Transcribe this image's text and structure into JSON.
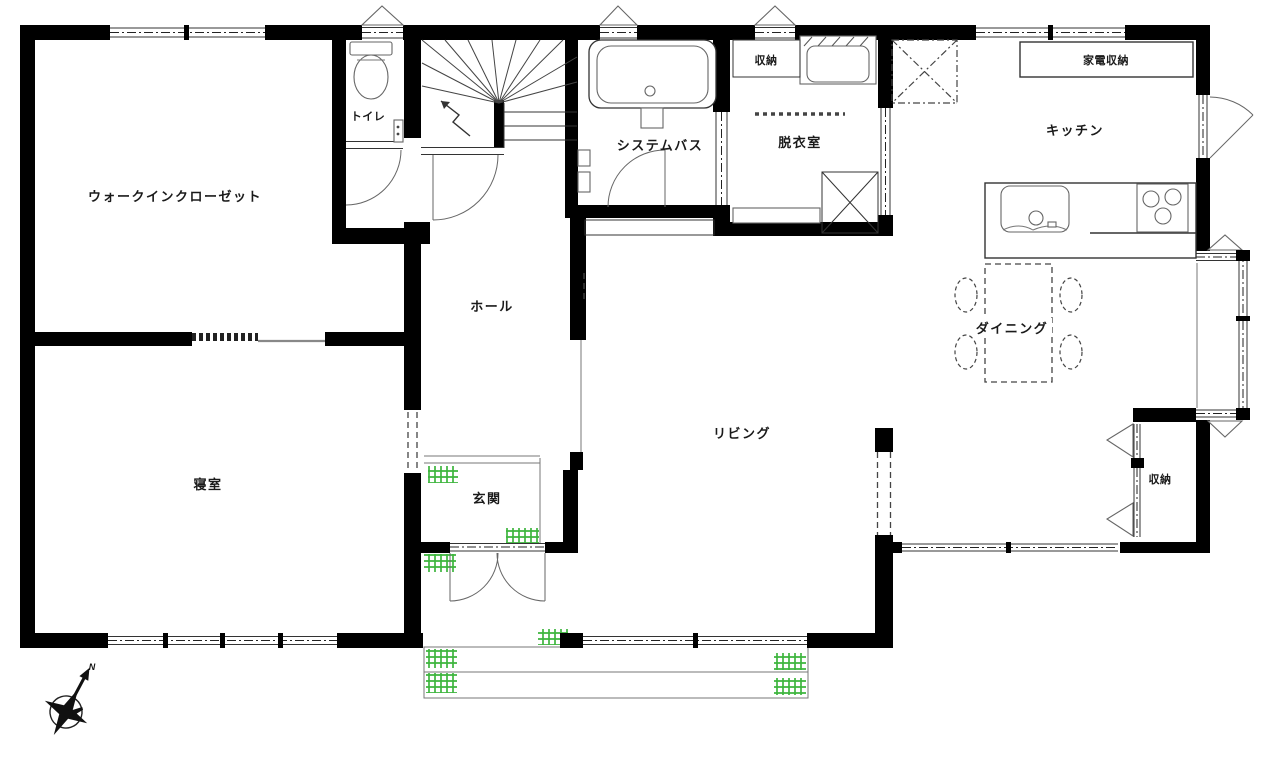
{
  "rooms": {
    "walk_in_closet": "ウォークインクローゼット",
    "toilet": "トイレ",
    "system_bath": "システムバス",
    "storage_upper": "収納",
    "dressing_room": "脱衣室",
    "kitchen": "キッチン",
    "appliance_storage": "家電収納",
    "hall": "ホール",
    "dining": "ダイニング",
    "living": "リビング",
    "bedroom": "寝室",
    "entrance": "玄関",
    "storage_lower": "収納"
  },
  "compass": {
    "north_label": "N"
  },
  "colors": {
    "wall": "#000000",
    "fixture_line": "#555555",
    "grass_green": "#3db53d",
    "background": "#ffffff"
  }
}
